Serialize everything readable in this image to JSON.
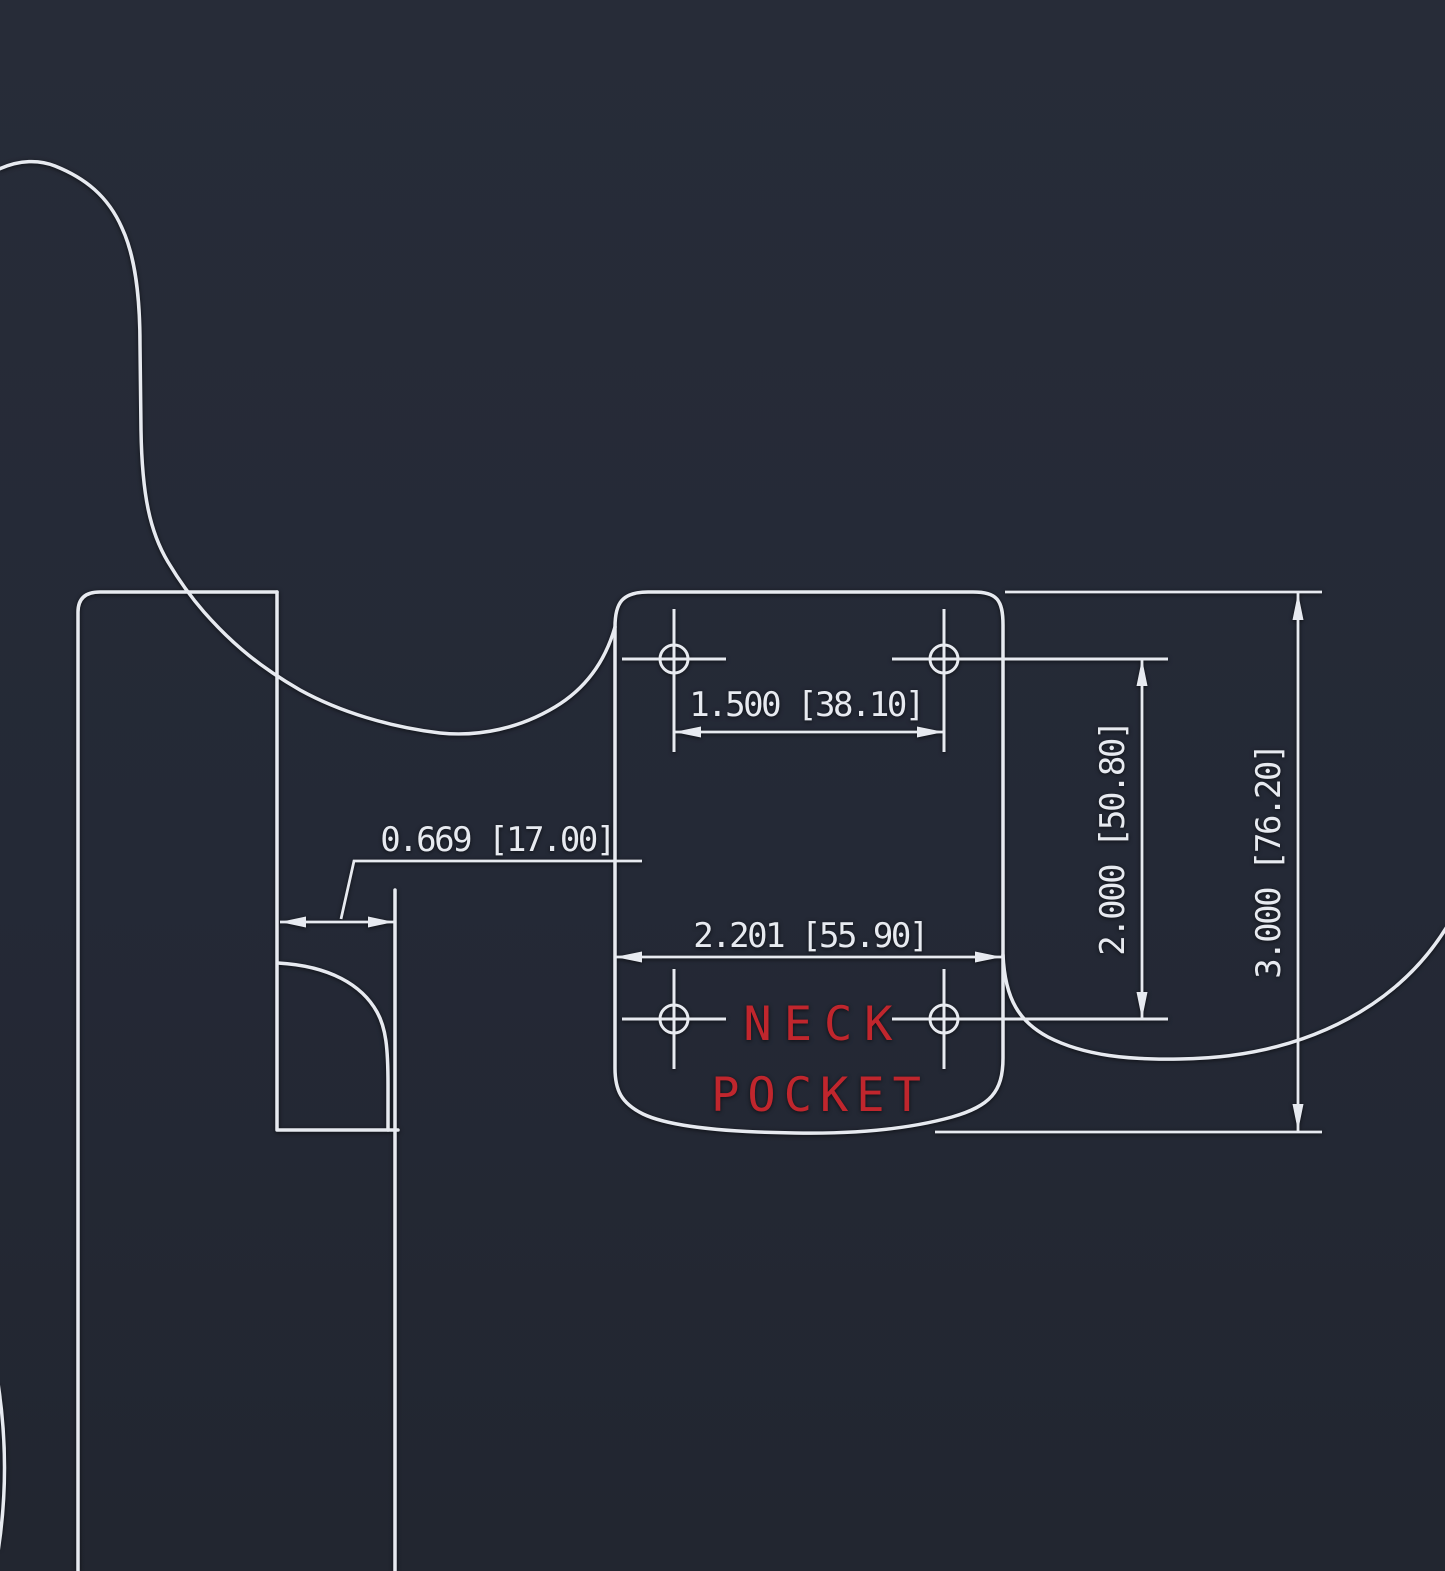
{
  "title": "Neck pocket dimension drawing",
  "colors": {
    "background": "#242936",
    "line": "#e7eaf0",
    "dimension_text": "#e7eaf0",
    "label_red": "#c0262d"
  },
  "pocket_label": {
    "line1": "NECK",
    "line2": "POCKET"
  },
  "dimensions": {
    "screw_hole_spacing_horizontal": {
      "label": "1.500  [38.10]"
    },
    "pocket_width": {
      "label": "2.201  [55.90]"
    },
    "heel_offset": {
      "label": "0.669  [17.00]"
    },
    "screw_hole_spacing_vertical": {
      "label": "2.000  [50.80]"
    },
    "pocket_length": {
      "label": "3.000  [76.20]"
    }
  }
}
